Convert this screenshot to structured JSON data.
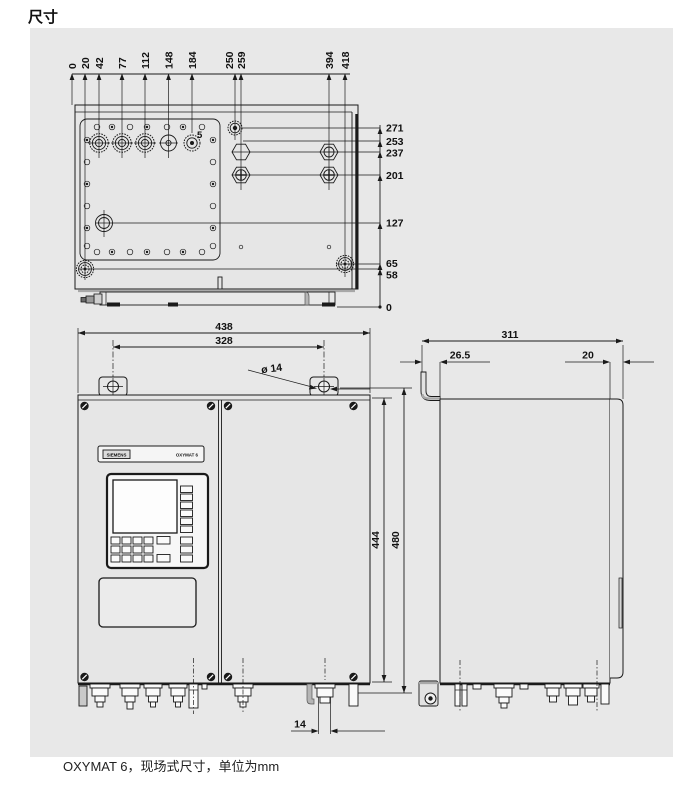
{
  "page": {
    "title": "尺寸",
    "caption": "OXYMAT 6，现场式尺寸，单位为mm"
  },
  "colors": {
    "background": "#e8e8e8",
    "line": "#1a1a1a"
  },
  "device": {
    "brand": "SIEMENS",
    "model": "OXYMAT 6"
  },
  "top_view": {
    "callout": "5",
    "x_ticks": [
      "0",
      "20",
      "42",
      "77",
      "112",
      "148",
      "184",
      "250",
      "259",
      "394",
      "418"
    ],
    "y_ticks": [
      "271",
      "253",
      "237",
      "201",
      "127",
      "65",
      "58",
      "0"
    ]
  },
  "front_view": {
    "width_total": "438",
    "width_mounting": "328",
    "hole_dia": "ø 14",
    "height_inner": "444",
    "height_total": "480",
    "gland_offset": "14"
  },
  "side_view": {
    "depth_total": "311",
    "bracket_offset": "26.5",
    "door_front_offset": "20"
  }
}
